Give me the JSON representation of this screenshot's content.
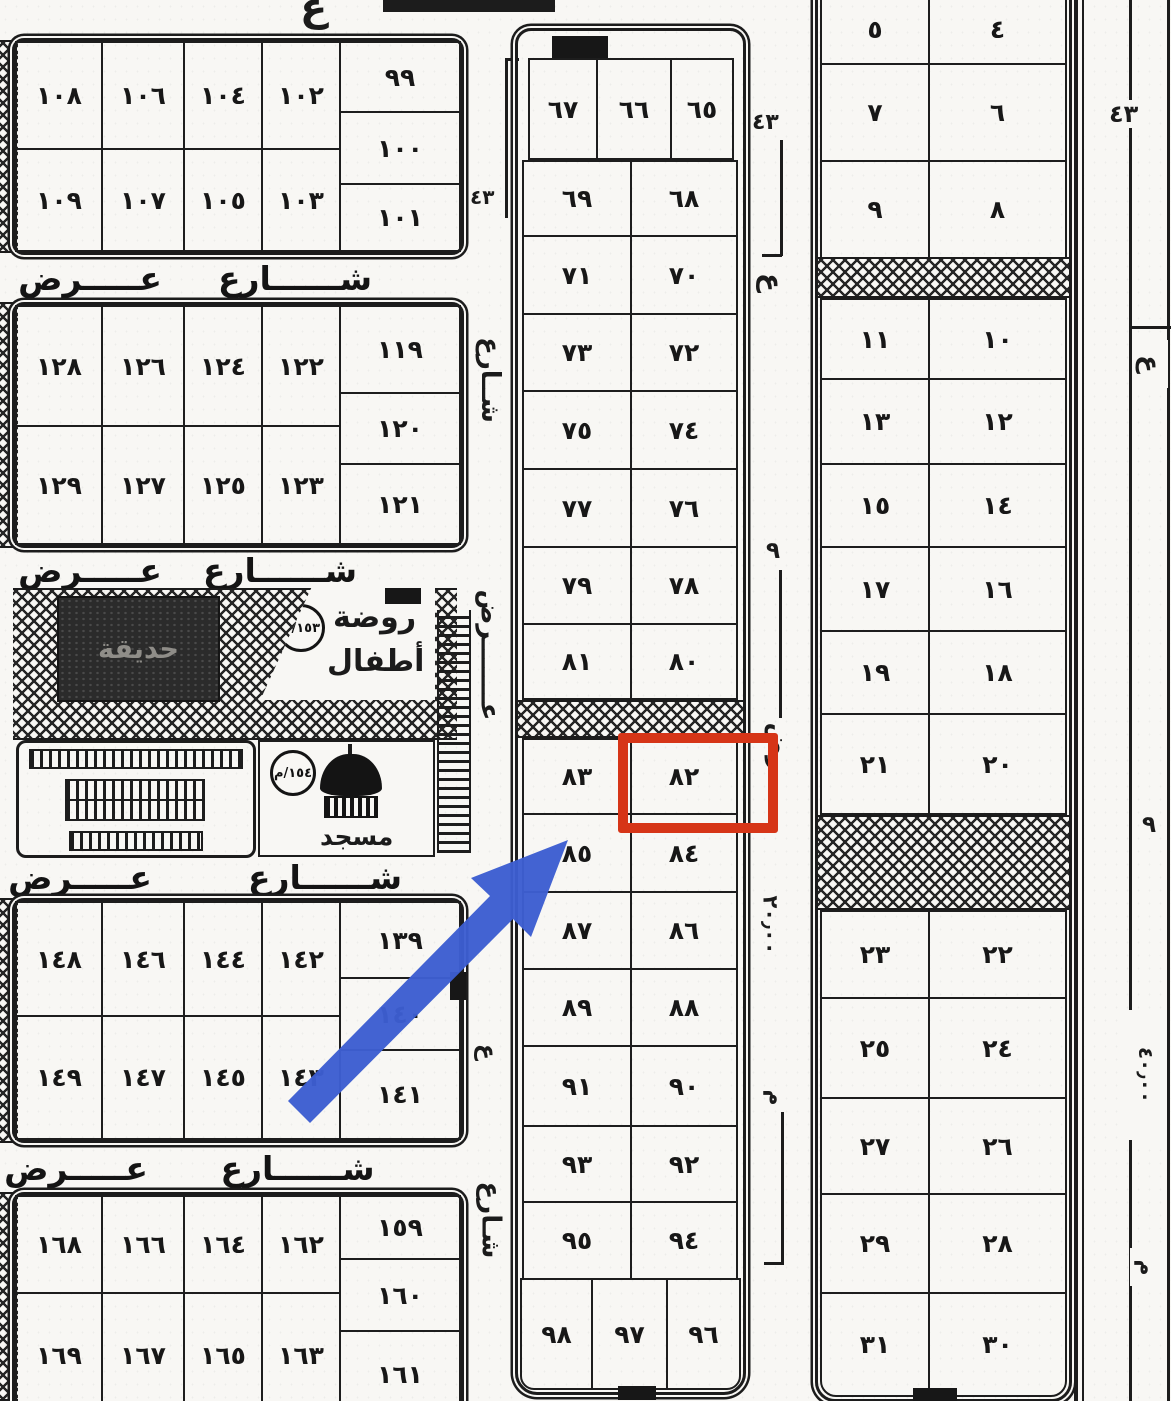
{
  "highlight": {
    "plot_number": "٨٢"
  },
  "streets": {
    "sharia": "شــــــارع",
    "ard": "عـــــرض",
    "v_sharia": "شــارع",
    "v_ard": "عـــــــرض",
    "v_sharia2": "شـارع"
  },
  "annotations": {
    "dim43": "٤٣",
    "dim20": "٢٠٫٠٠",
    "dim40": "٤٠٫٠٠",
    "ain": "ع",
    "rad": "رض",
    "nine": "٩",
    "meem": "م"
  },
  "facilities": {
    "garden": "حديقة",
    "kg1": "روضة",
    "kg2": "أطفال",
    "kg_code": "١٥٣/م",
    "mosque": "مسجد",
    "mosque_code": "١٥٤/م"
  },
  "blocks": {
    "b100": {
      "r1": [
        "١٠٨",
        "١٠٦",
        "١٠٤",
        "١٠٢"
      ],
      "side": [
        "٩٩",
        "١٠٠",
        "١٠١"
      ],
      "r2": [
        "١٠٩",
        "١٠٧",
        "١٠٥",
        "١٠٣"
      ]
    },
    "b120": {
      "r1": [
        "١٢٨",
        "١٢٦",
        "١٢٤",
        "١٢٢"
      ],
      "side": [
        "١١٩",
        "١٢٠",
        "١٢١"
      ],
      "r2": [
        "١٢٩",
        "١٢٧",
        "١٢٥",
        "١٢٣"
      ]
    },
    "b140": {
      "r1": [
        "١٤٨",
        "١٤٦",
        "١٤٤",
        "١٤٢"
      ],
      "side": [
        "١٣٩",
        "١٤٠",
        "١٤١"
      ],
      "r2": [
        "١٤٩",
        "١٤٧",
        "١٤٥",
        "١٤٣"
      ]
    },
    "b160": {
      "r1": [
        "١٦٨",
        "١٦٦",
        "١٦٤",
        "١٦٢"
      ],
      "side": [
        "١٥٩",
        "١٦٠",
        "١٦١"
      ],
      "r2": [
        "١٦٩",
        "١٦٧",
        "١٦٥",
        "١٦٣"
      ]
    },
    "mid": {
      "top": [
        "٦٧",
        "٦٦",
        "٦٥"
      ],
      "rows": [
        [
          "٦٩",
          "٦٨"
        ],
        [
          "٧١",
          "٧٠"
        ],
        [
          "٧٣",
          "٧٢"
        ],
        [
          "٧٥",
          "٧٤"
        ],
        [
          "٧٧",
          "٧٦"
        ],
        [
          "٧٩",
          "٧٨"
        ],
        [
          "٨١",
          "٨٠"
        ],
        [
          "٨٣",
          "٨٢"
        ],
        [
          "٨٥",
          "٨٤"
        ],
        [
          "٨٧",
          "٨٦"
        ],
        [
          "٨٩",
          "٨٨"
        ],
        [
          "٩١",
          "٩٠"
        ],
        [
          "٩٣",
          "٩٢"
        ],
        [
          "٩٥",
          "٩٤"
        ]
      ],
      "bottom": [
        "٩٨",
        "٩٧",
        "٩٦"
      ]
    },
    "right": {
      "rows": [
        [
          "٥",
          "٤"
        ],
        [
          "٧",
          "٦"
        ],
        [
          "٩",
          "٨"
        ],
        [
          "١١",
          "١٠"
        ],
        [
          "١٣",
          "١٢"
        ],
        [
          "١٥",
          "١٤"
        ],
        [
          "١٧",
          "١٦"
        ],
        [
          "١٩",
          "١٨"
        ],
        [
          "٢١",
          "٢٠"
        ],
        [
          "٢٣",
          "٢٢"
        ],
        [
          "٢٥",
          "٢٤"
        ],
        [
          "٢٧",
          "٢٦"
        ],
        [
          "٢٩",
          "٢٨"
        ],
        [
          "٣١",
          "٣٠"
        ]
      ]
    }
  }
}
